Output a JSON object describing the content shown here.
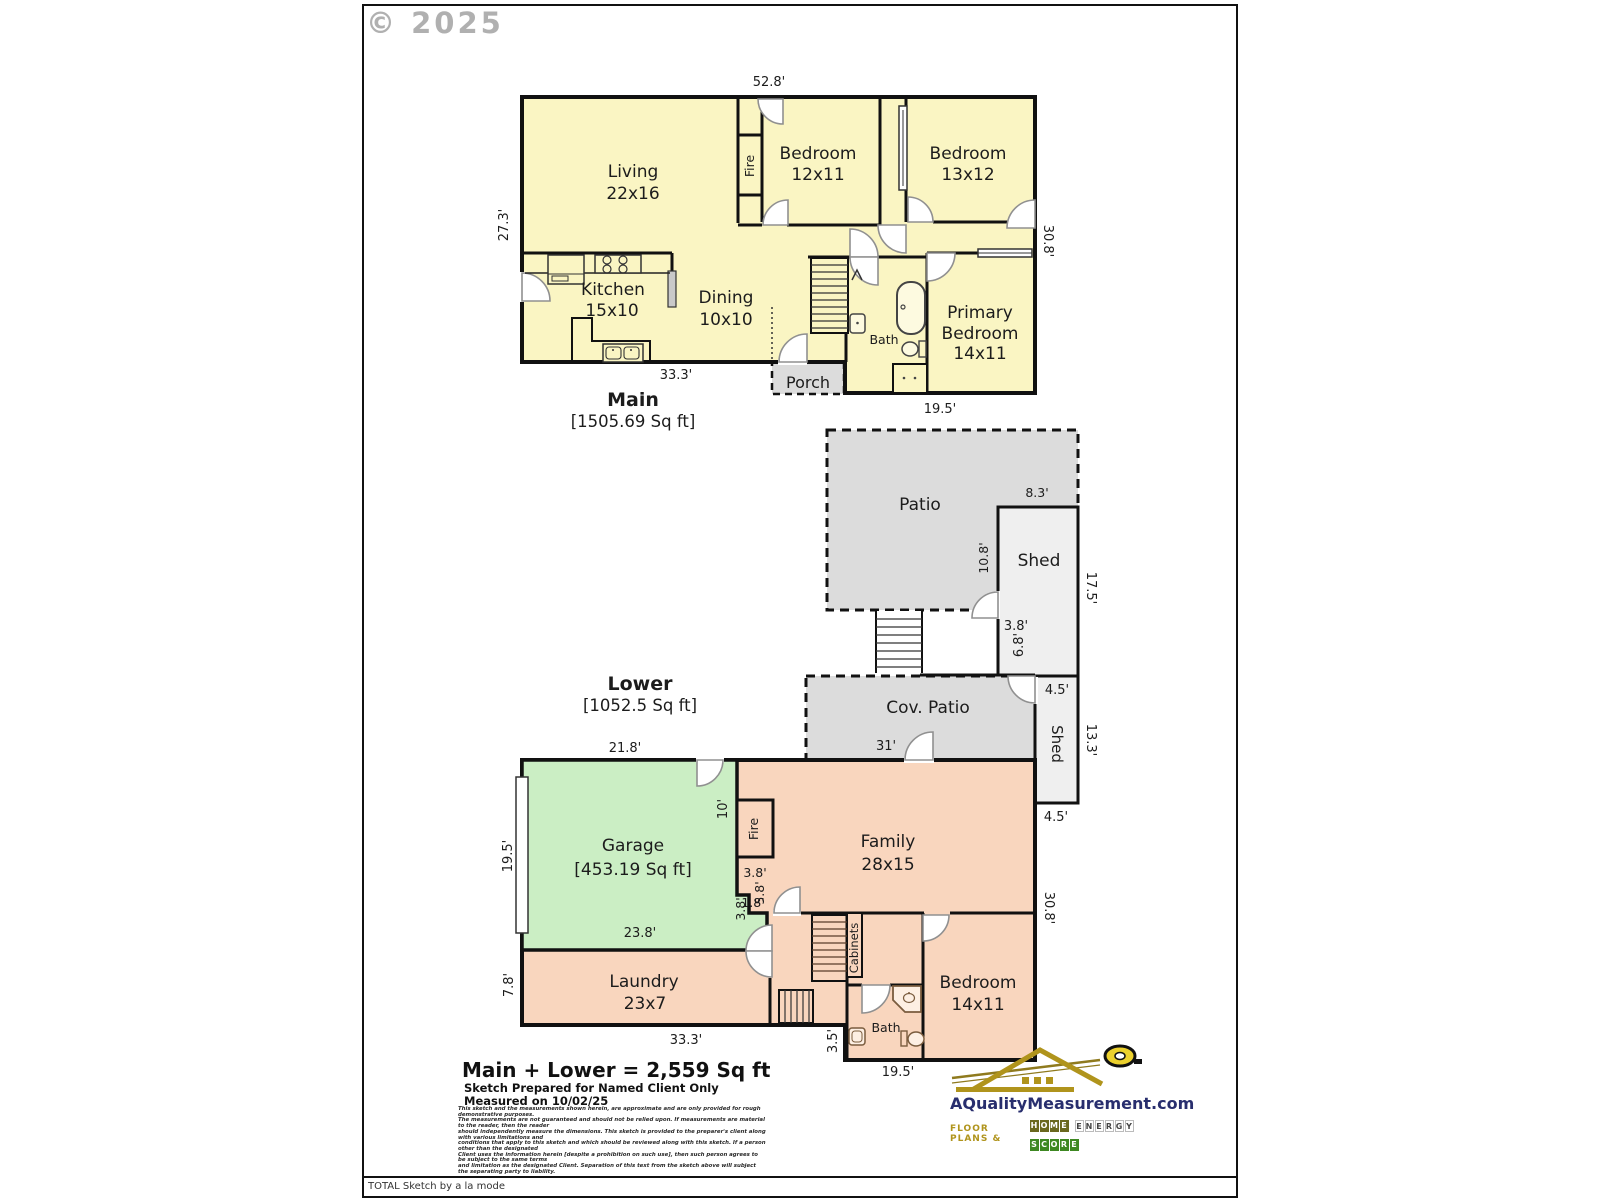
{
  "watermark": "© 2025",
  "credit": "TOTAL Sketch by a la mode",
  "main_floor": {
    "title": "Main",
    "sqft": "[1505.69 Sq ft]",
    "rooms": {
      "living": {
        "name": "Living",
        "size": "22x16"
      },
      "bedroom1": {
        "name": "Bedroom",
        "size": "12x11"
      },
      "bedroom2": {
        "name": "Bedroom",
        "size": "13x12"
      },
      "kitchen": {
        "name": "Kitchen",
        "size": "15x10"
      },
      "dining": {
        "name": "Dining",
        "size": "10x10"
      },
      "primary": {
        "line1": "Primary",
        "line2": "Bedroom",
        "size": "14x11"
      },
      "bath": "Bath",
      "fire": "Fire",
      "porch": "Porch"
    },
    "dims": {
      "top": "52.8'",
      "left": "27.3'",
      "bottom_left": "33.3'",
      "bottom_right": "19.5'",
      "right": "30.8'"
    }
  },
  "outdoor": {
    "patio": "Patio",
    "shed1": "Shed",
    "shed2": "Shed",
    "cov_patio": "Cov. Patio",
    "dims": {
      "shed1_width": "8.3'",
      "patio_shed_side": "10.8'",
      "shed1_height": "17.5'",
      "stairs_width": "3.8'",
      "stairs_height": "6.8'",
      "shed2_top": "4.5'",
      "cov_patio_width": "31'",
      "shed2_height": "13.3'",
      "shed2_bottom": "4.5'"
    }
  },
  "lower_floor": {
    "title": "Lower",
    "sqft": "[1052.5 Sq ft]",
    "rooms": {
      "garage": {
        "name": "Garage",
        "sqft": "[453.19 Sq ft]"
      },
      "family": {
        "name": "Family",
        "size": "28x15"
      },
      "laundry": {
        "name": "Laundry",
        "size": "23x7"
      },
      "bedroom": {
        "name": "Bedroom",
        "size": "14x11"
      },
      "bath": "Bath",
      "fire": "Fire",
      "cabinets": "Cabinets"
    },
    "dims": {
      "top": "21.8'",
      "garage_left": "19.5'",
      "laundry_left": "7.8'",
      "garage_hall": "10'",
      "jog_a": "3.8'",
      "jog_b": "5.8'",
      "jog_c": "1.8'",
      "jog_d": "3.8'",
      "garage_bottom": "23.8'",
      "bottom_left": "33.3'",
      "bath_left": "3.5'",
      "bottom_right": "19.5'",
      "right": "30.8'"
    }
  },
  "footer": {
    "total": "Main + Lower = 2,559 Sq ft",
    "prepared": "Sketch Prepared for Named Client Only",
    "measured": "Measured on 10/02/25",
    "disclaimer_lines": [
      "This sketch and the measurements shown herein, are approximate and are only provided for rough demonstrative purposes.",
      "The measurements are not guaranteed and should not be relied upon.  If measurements are material to the reader, then the reader",
      "should independently measure the dimensions.  This sketch is provided to the preparer's client along with various limitations and",
      "conditions that apply to this sketch and which should be reviewed along with this sketch.  If a person other than the designated",
      "Client uses the information herein [despite a prohibition on such use], then such person agrees to be subject to the same terms",
      "and limitation as the designated Client.  Separation of this text from the sketch above will subject the separating party to liability."
    ]
  },
  "logo": {
    "domain": "AQualityMeasurement.com",
    "tagline_prefix": "Floor Plans &",
    "tagline_boxes": "HOME ENERGY SCORE"
  },
  "colors": {
    "main_fill": "#FAF5C3",
    "lower_fill": "#F9D6BE",
    "garage_fill": "#CBEEC4",
    "patio_fill": "#DCDCDC",
    "shed_fill": "#EFEFEF",
    "wall": "#111111",
    "logo_navy": "#282e6e",
    "logo_gold": "#b0941c"
  }
}
